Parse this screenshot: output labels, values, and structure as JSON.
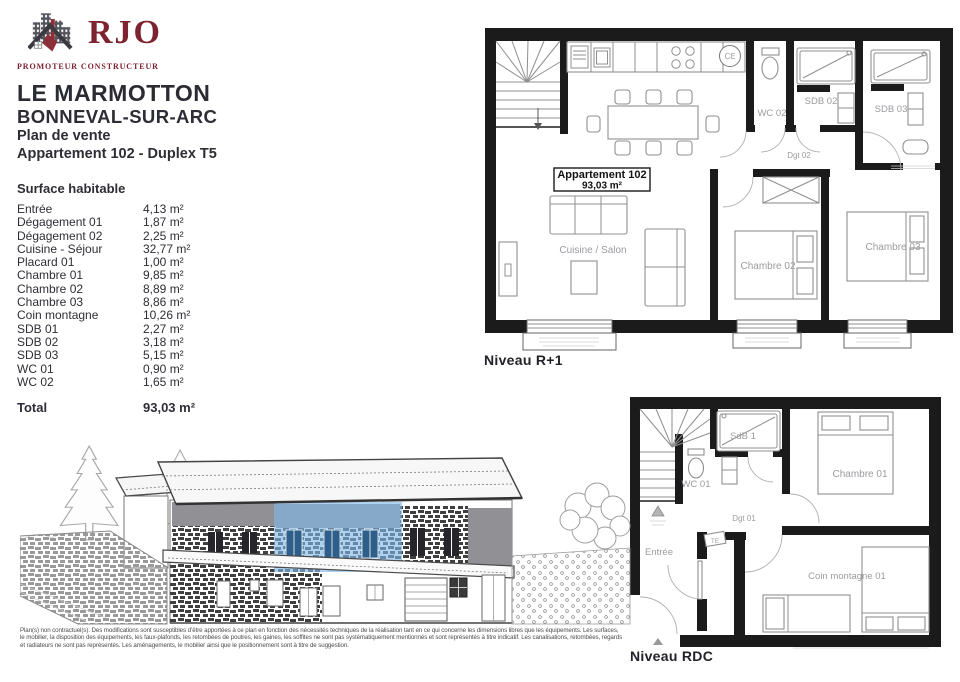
{
  "brand": {
    "name": "RJO",
    "tagline": "PROMOTEUR CONSTRUCTEUR",
    "colors": {
      "brand_maroon": "#7d2330",
      "building_gray": "#54545c"
    }
  },
  "header": {
    "project": "LE MARMOTTON",
    "location": "BONNEVAL-SUR-ARC",
    "document": "Plan de vente",
    "unit": "Appartement 102 - Duplex T5"
  },
  "surface_table": {
    "title": "Surface habitable",
    "rows": [
      {
        "label": "Entrée",
        "value": "4,13 m²"
      },
      {
        "label": "Dégagement 01",
        "value": "1,87 m²"
      },
      {
        "label": "Dégagement 02",
        "value": "2,25 m²"
      },
      {
        "label": "Cuisine - Séjour",
        "value": "32,77 m²"
      },
      {
        "label": "Placard 01",
        "value": "1,00 m²"
      },
      {
        "label": "Chambre 01",
        "value": "9,85 m²"
      },
      {
        "label": "Chambre 02",
        "value": "8,89 m²"
      },
      {
        "label": "Chambre 03",
        "value": "8,86 m²"
      },
      {
        "label": "Coin montagne",
        "value": "10,26 m²"
      },
      {
        "label": "SDB 01",
        "value": "2,27 m²"
      },
      {
        "label": "SDB 02",
        "value": "3,18 m²"
      },
      {
        "label": "SDB 03",
        "value": "5,15 m²"
      },
      {
        "label": "WC 01",
        "value": "0,90 m²"
      },
      {
        "label": "WC 02",
        "value": "1,65 m²"
      }
    ],
    "total_label": "Total",
    "total_value": "93,03 m²"
  },
  "plan_r1": {
    "caption": "Niveau R+1",
    "box_title": "Appartement 102",
    "box_area": "93,03 m²",
    "labels": {
      "ce": "CE",
      "wc02": "WC 02",
      "sdb02": "SDB 02",
      "sdb03": "SDB 03",
      "dgt02": "Dgt 02",
      "chambre02": "Chambre 02",
      "chambre03": "Chambre 03",
      "cuisine_salon": "Cuisine / Salon"
    }
  },
  "plan_rdc": {
    "caption": "Niveau RDC",
    "labels": {
      "wc01": "WC 01",
      "sdb1": "SdB 1",
      "chambre01": "Chambre 01",
      "dgt01": "Dgt 01",
      "te": "TE",
      "entree": "Entrée",
      "coin_montagne": "Coin montagne 01"
    }
  },
  "elevation": {
    "highlight_color": "#7fb7e8"
  },
  "footer": {
    "lines": [
      "Plan(s) non contractuel(s). Des modifications sont susceptibles d’être apportées à ce plan en fonction des nécessités techniques de la réalisation tant en ce qui concerne les dimensions libres que les équipements. Les surfaces,",
      "le mobilier, la disposition des équipements, les faux-plafonds, les retombées de poutres, les gaines, les soffites ne sont pas systématiquement mentionnés et sont représentés à titre indicatif. Les canalisations, retombées, regards",
      "et radiateurs ne sont pas représentés. Les aménagements, le mobilier ainsi que le positionnement sont à titre de suggestion."
    ]
  }
}
